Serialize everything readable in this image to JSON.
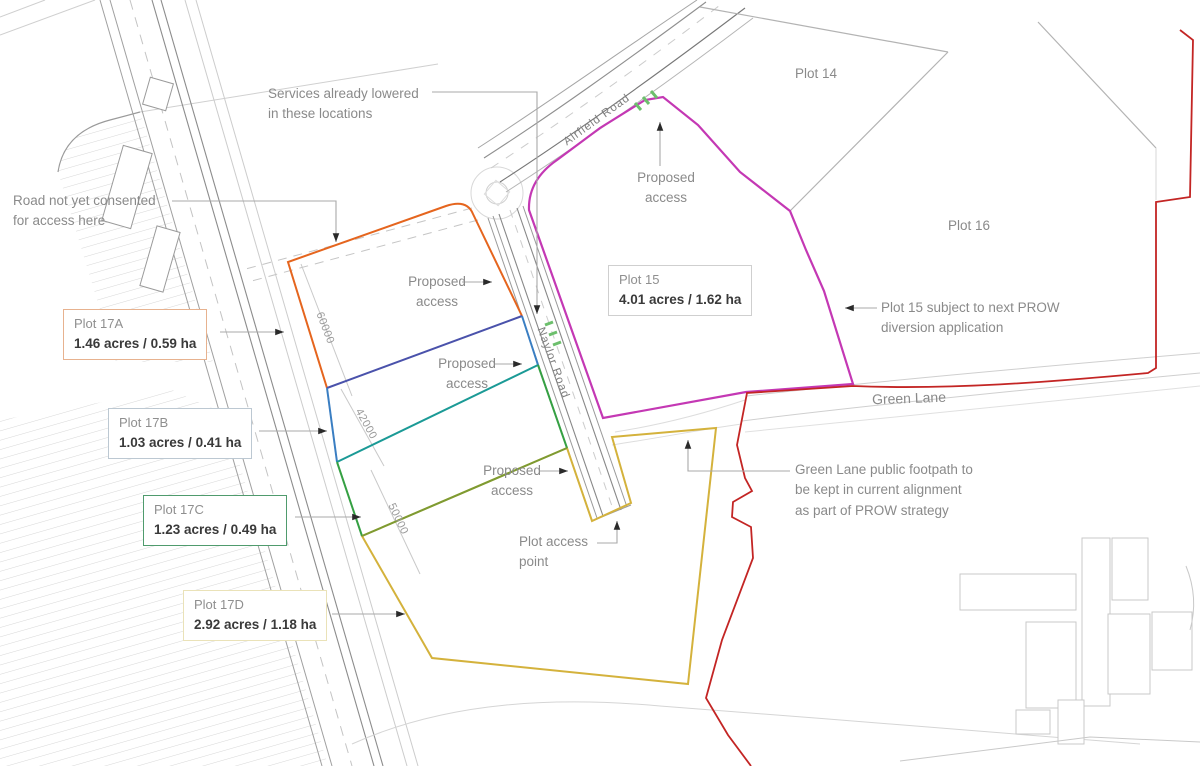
{
  "canvas": {
    "width": 1200,
    "height": 766
  },
  "roads": {
    "airfield_road": "Airfield Road",
    "naylor_road": "Naylor Road",
    "green_lane": "Green Lane"
  },
  "plot_boxes": {
    "plot17a": {
      "title": "Plot 17A",
      "area": "1.46 acres / 0.59 ha",
      "border_color": "#e7b28f"
    },
    "plot17b": {
      "title": "Plot 17B",
      "area": "1.03 acres / 0.41 ha",
      "border_color": "#bcc8d2"
    },
    "plot17c": {
      "title": "Plot 17C",
      "area": "1.23 acres / 0.49 ha",
      "border_color": "#4f9b6d"
    },
    "plot17d": {
      "title": "Plot 17D",
      "area": "2.92 acres / 1.18 ha",
      "border_color": "#eae2b8"
    },
    "plot15": {
      "title": "Plot 15",
      "area": "4.01 acres / 1.62 ha",
      "border_color": "#cfcfcf"
    }
  },
  "plot_labels": {
    "plot14": "Plot 14",
    "plot16": "Plot 16"
  },
  "annotations": {
    "services": {
      "lines": [
        "Services already lowered",
        "in these locations"
      ]
    },
    "road_not_consented": {
      "lines": [
        "Road not yet consented",
        "for access here"
      ]
    },
    "proposed_access": {
      "lines": [
        "Proposed",
        "access"
      ]
    },
    "plot_access_point": {
      "lines": [
        "Plot access",
        "point"
      ]
    },
    "green_lane_footpath": {
      "lines": [
        "Green Lane public footpath to",
        "be kept in current alignment",
        "as part of PROW strategy"
      ]
    },
    "prow_diversion": {
      "lines": [
        "Plot 15 subject to next PROW",
        "diversion application"
      ]
    }
  },
  "dimensions": {
    "plot17a": "60000",
    "plot17b": "42000",
    "plot17c": "50000"
  },
  "boundary_colors": {
    "plot17a": "#e5651e",
    "divider_17a_17b": "#4a52ab",
    "plot17b": "#3a7ec2",
    "divider_17b_17c": "#1b9a96",
    "plot17c": "#35a043",
    "divider_17c_17d": "#7d9b33",
    "plot17d": "#d4b23c",
    "plot15": "#c438b4",
    "site_boundary": "#c32524",
    "services_marks": "#6cbf6c"
  }
}
